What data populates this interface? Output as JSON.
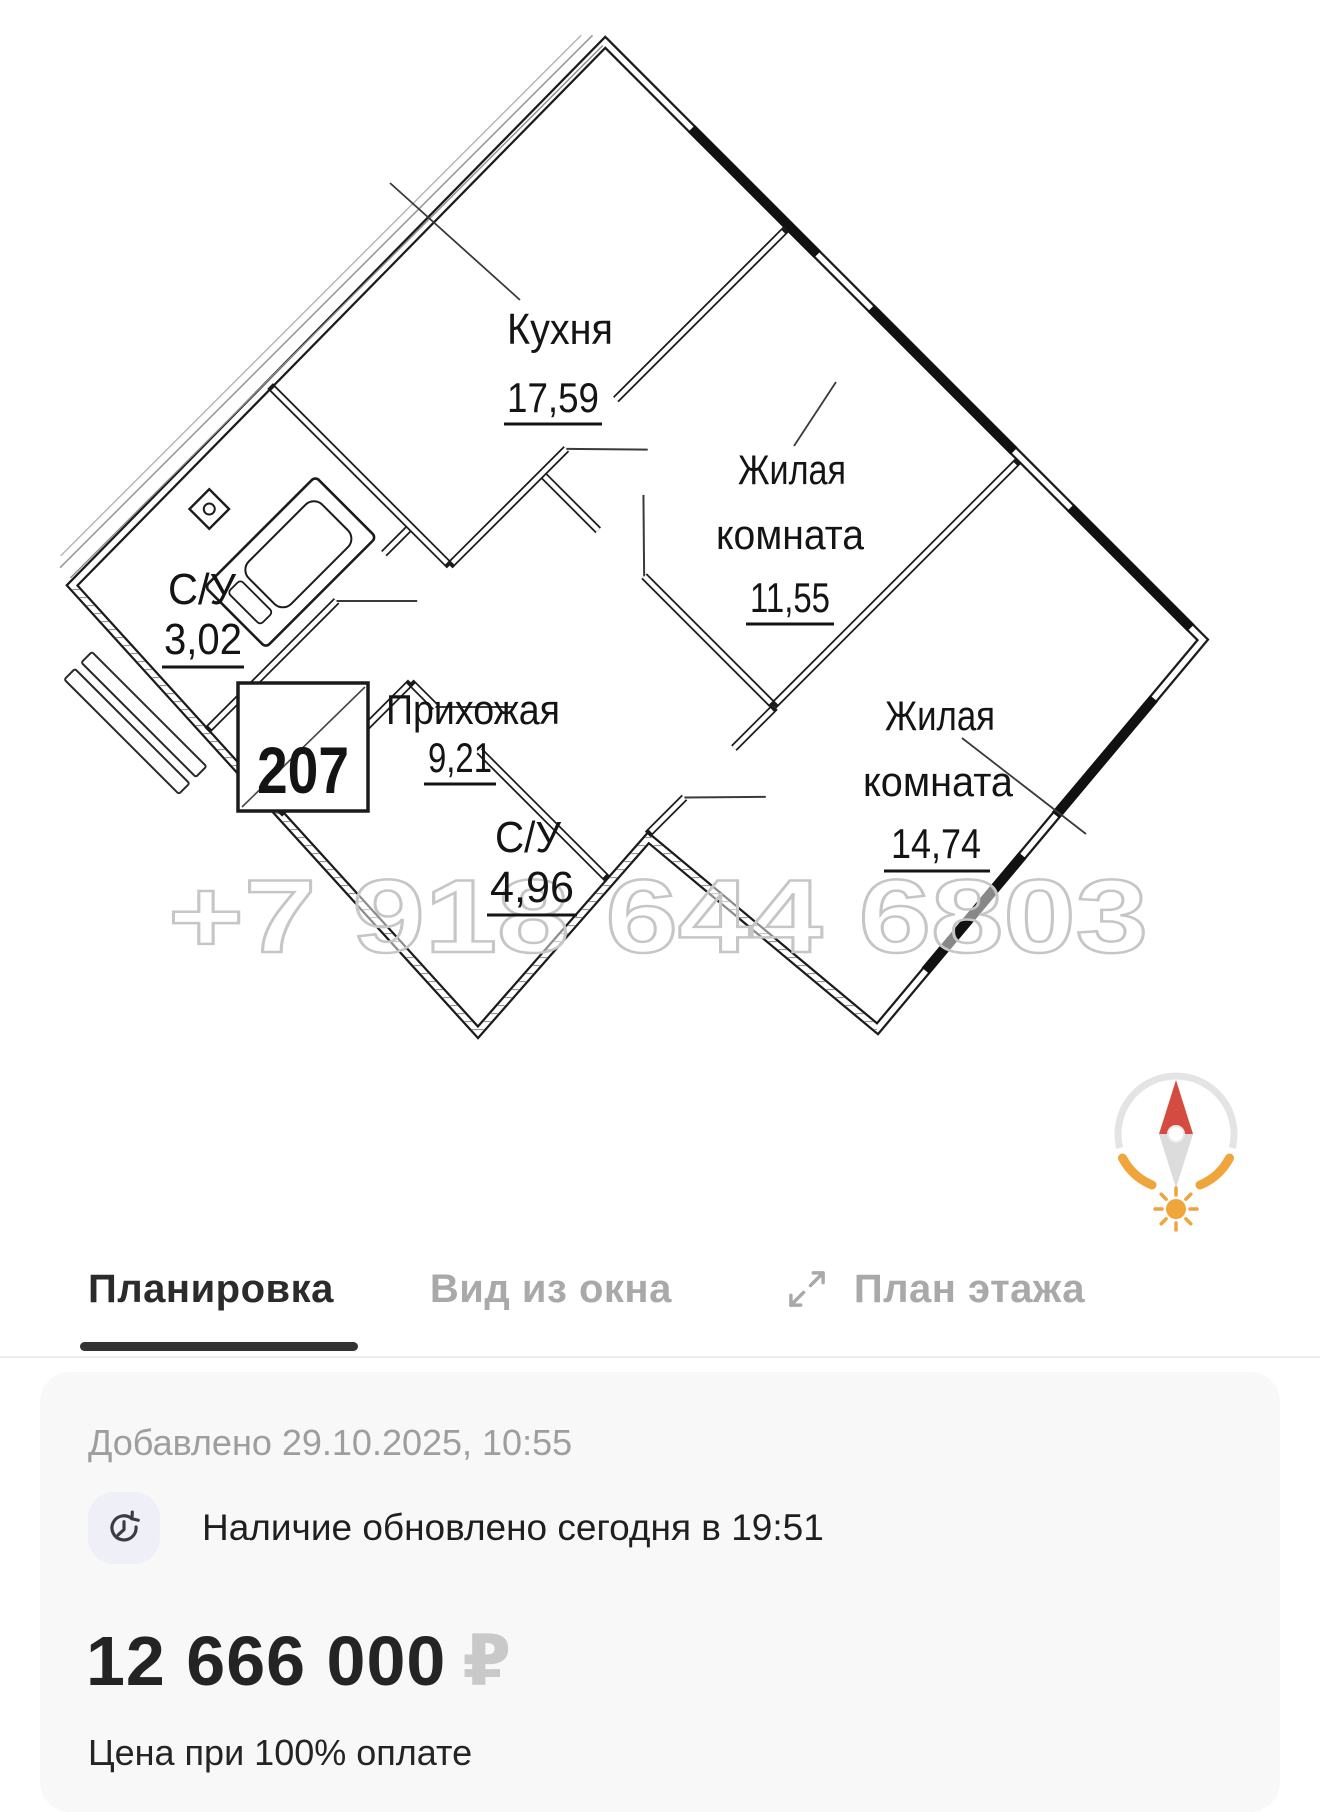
{
  "plan": {
    "unit_number": "207",
    "watermark": "+7 918 644 6803",
    "rooms": {
      "kitchen": {
        "name": "Кухня",
        "area": "17,59"
      },
      "living1": {
        "name_line1": "Жилая",
        "name_line2": "комната",
        "area": "11,55"
      },
      "living2": {
        "name_line1": "Жилая",
        "name_line2": "комната",
        "area": "14,74"
      },
      "bathroom1": {
        "name": "С/У",
        "area": "3,02"
      },
      "hallway": {
        "name": "Прихожая",
        "area": "9,21"
      },
      "bathroom2": {
        "name": "С/У",
        "area": "4,96"
      }
    }
  },
  "tabs": {
    "layout": "Планировка",
    "window_view": "Вид из окна",
    "floor_plan": "План этажа"
  },
  "details": {
    "added": "Добавлено 29.10.2025, 10:55",
    "availability": "Наличие обновлено сегодня в 19:51"
  },
  "price": {
    "amount": "12 666 000",
    "currency": "₽",
    "note": "Цена при 100% оплате"
  },
  "colors": {
    "accent_dark": "#2b2b2b",
    "inactive_gray": "#a9a9a9",
    "compass_red": "#d44c41",
    "compass_orange": "#f0a43c",
    "card_bg": "#f8f8f8"
  }
}
